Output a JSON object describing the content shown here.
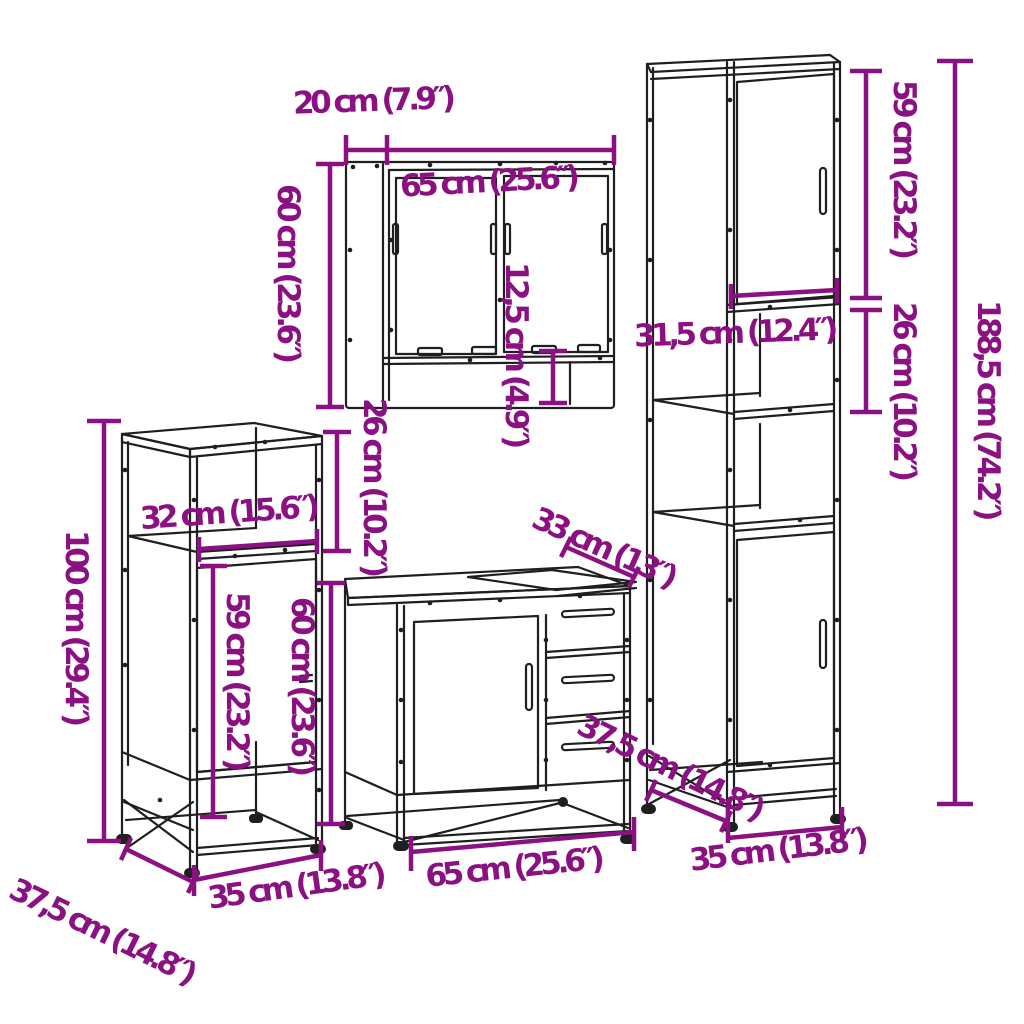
{
  "colors": {
    "dimension_annotation": "#8B1182",
    "line_art": "#1F1F1F",
    "background": "#FFFFFF"
  },
  "mirror_cabinet": {
    "depth_label": "20 cm (7.9″)",
    "width_label": "65 cm (25.6″)",
    "height_label": "60 cm (23.6″)",
    "open_shelf_label": "12,5 cm (4.9″)",
    "bottom_section_label": "26 cm (10.2″)"
  },
  "side_cabinet": {
    "height_label": "100 cm (29.4″)",
    "shelf_width_label": "32 cm (15.6″)",
    "door_height_label": "59 cm (23.2″)",
    "front_height_label": "60 cm (23.6″)",
    "width_label": "35 cm (13.8″)",
    "depth_label": "37,5 cm (14.8″)"
  },
  "sink_cabinet": {
    "top_section_label": "33 cm (13″)",
    "width_label": "65 cm (25.6″)"
  },
  "tall_cabinet": {
    "upper_door_label": "59 cm (23.2″)",
    "shelf_section_label": "26 cm (10.2″)",
    "inner_width_label": "31,5 cm (12.4″)",
    "height_label": "188,5 cm (74.2″)",
    "width_label": "35 cm (13.8″)",
    "depth_label": "37,5 cm (14.8″)"
  }
}
